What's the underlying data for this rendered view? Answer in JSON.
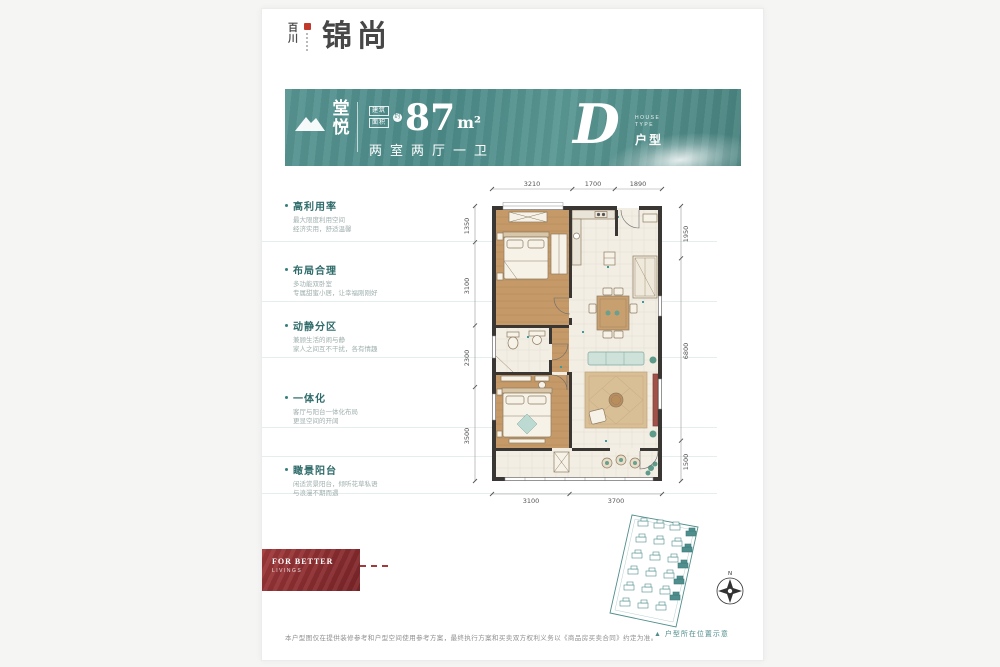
{
  "logo": {
    "brand_vertical": "百川",
    "brand_main": "锦尚"
  },
  "banner": {
    "accent": "#4c8a88",
    "product_char_1": "堂",
    "product_char_2": "悦",
    "area_label_top": "建筑",
    "area_label_bottom": "面积",
    "approx": "约",
    "area_value": "87",
    "area_unit": "m²",
    "layout_text": "两室两厅一卫",
    "type_letter": "D",
    "type_en_line1": "HOUSE",
    "type_en_line2": "TYPE",
    "type_cn": "户型"
  },
  "features": [
    {
      "title": "高利用率",
      "line1": "最大限度利用空间",
      "line2": "经济实用，舒适温馨"
    },
    {
      "title": "布局合理",
      "line1": "多功能双卧室",
      "line2": "专属甜蜜小居，让幸福刚刚好"
    },
    {
      "title": "动静分区",
      "line1": "兼顾生活的闹与静",
      "line2": "家人之间互不干扰，各有情趣"
    },
    {
      "title": "一体化",
      "line1": "客厅与阳台一体化布局",
      "line2": "更显空间的开阔"
    },
    {
      "title": "瞰景阳台",
      "line1": "闲适赏景阳台，倾听花草私语",
      "line2": "与浪漫不期而遇"
    }
  ],
  "floorplan": {
    "dims": {
      "top": [
        "3210",
        "1700",
        "1890"
      ],
      "bottom": [
        "3100",
        "3700"
      ],
      "left": [
        "1350",
        "3100",
        "2300",
        "3500"
      ],
      "right": [
        "1950",
        "6800",
        "1500"
      ]
    }
  },
  "siteplan": {
    "caption": "▲ 户型所在位置示意",
    "compass_n": "N"
  },
  "redbox": {
    "line1": "FOR BETTER",
    "line2": "LIVINGS"
  },
  "footer": {
    "disclaimer": "本户型图仅在提供装修参考和户型空间使用参考方案，最终执行方案和买卖双方权利义务以《商品房买卖合同》约定为准。"
  }
}
